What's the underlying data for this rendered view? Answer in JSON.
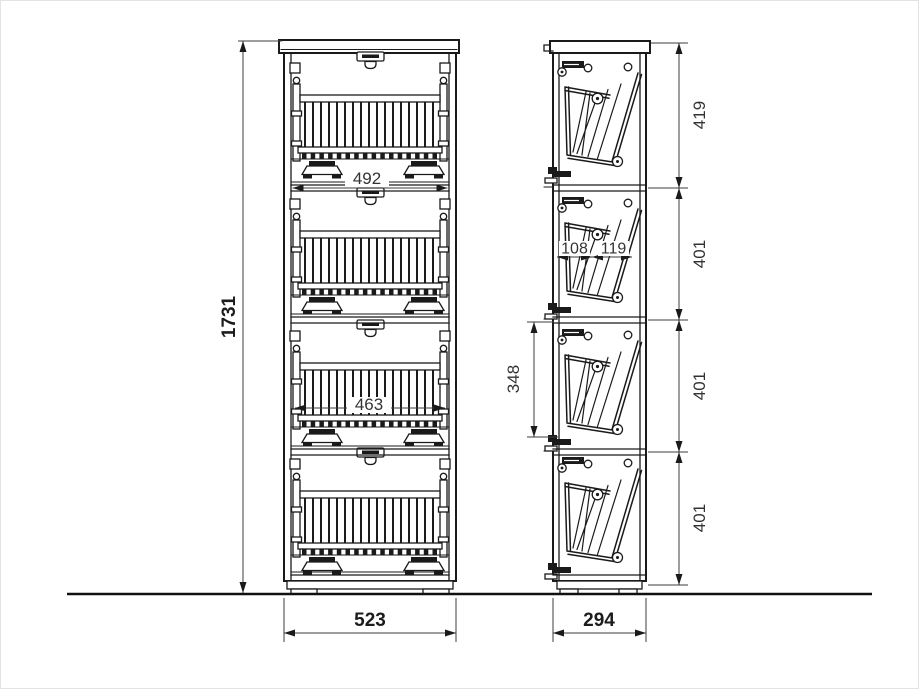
{
  "dimensions": {
    "overall_height": "1731",
    "cabinet_width": "523",
    "cabinet_depth": "294",
    "opening_width": "492",
    "basket_width": "463",
    "section_heights": [
      "419",
      "401",
      "401",
      "401"
    ],
    "shelf_spacing": "348",
    "basket_depth_segments": [
      "108",
      "119"
    ]
  },
  "colors": {
    "line": "#1a1a1a",
    "dimension_text": "#333333",
    "background": "#ffffff"
  }
}
